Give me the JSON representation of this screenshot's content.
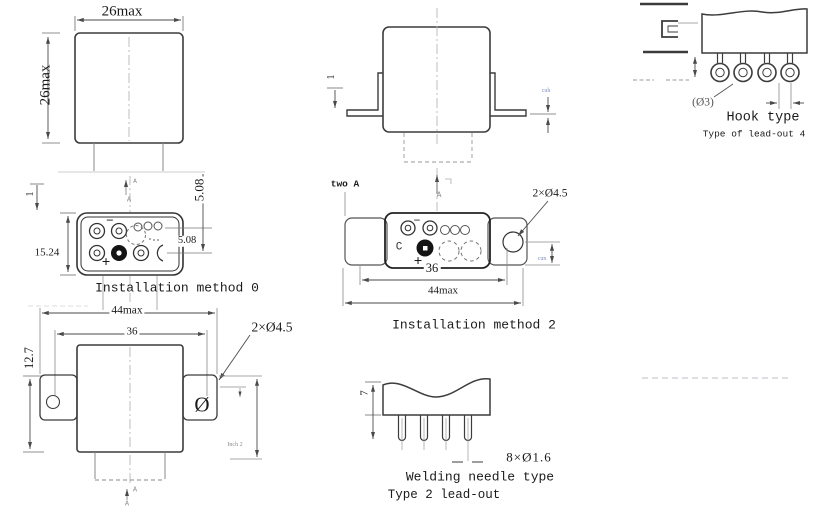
{
  "top_view": {
    "width": "26max",
    "height": "26max"
  },
  "side_view": {
    "lip": "1",
    "watermark": "cuh"
  },
  "method0": {
    "title": "Installation method 0",
    "height": "15.24",
    "pitch_v": "5.08",
    "pitch_h": "5.08",
    "lip": "1",
    "minus": "−",
    "plus": "+",
    "section_a": "A",
    "section_a2": "A"
  },
  "method2": {
    "title": "Installation method 2",
    "note": "two A",
    "section_a": "A",
    "minus": "−",
    "plus": "+",
    "c": "C",
    "dim36": "36",
    "dim44": "44max",
    "holes": "2×Ø4.5",
    "watermark": "cun"
  },
  "bottom_view": {
    "dim44": "44max",
    "dim36": "36",
    "holes": "2×Ø4.5",
    "height": "12.7",
    "hole": "Ø",
    "note": "Inch 2",
    "section_a": "A",
    "section_a2": "A"
  },
  "hook": {
    "title": "Hook type",
    "subtitle": "Type of lead-out 4",
    "dia": "(Ø3)"
  },
  "welding": {
    "title": "Welding needle type",
    "subtitle": "Type 2 lead-out",
    "height": "7",
    "pins": "8×Ø1.6"
  }
}
